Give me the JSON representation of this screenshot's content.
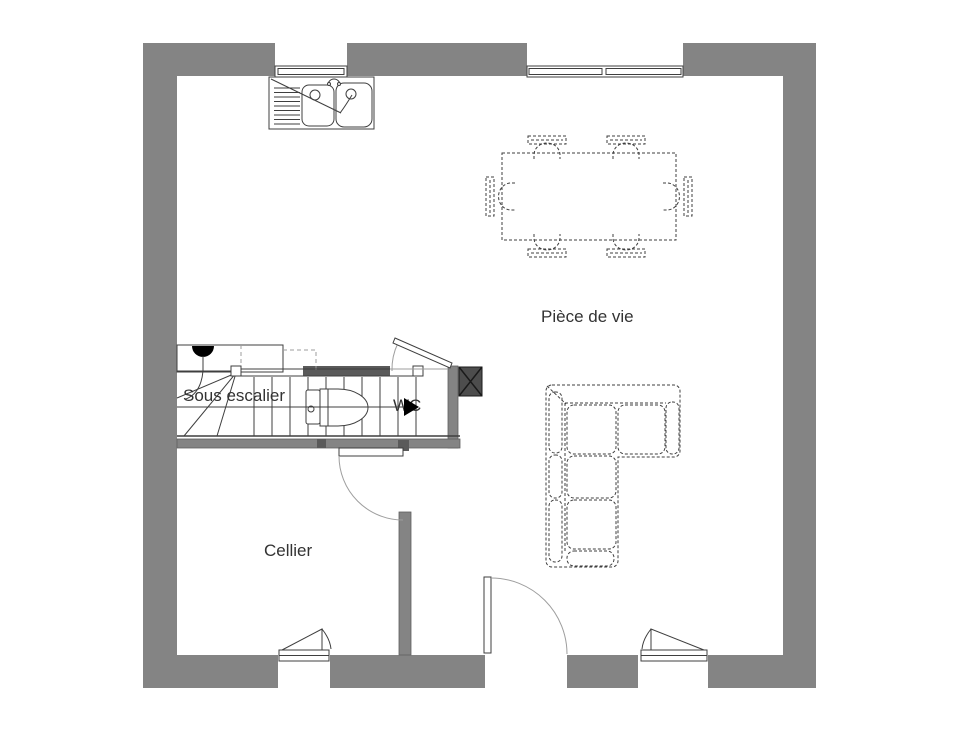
{
  "labels": {
    "living_room": "Pièce de vie",
    "cellar": "Cellier",
    "under_stairs": "Sous escalier",
    "wc": "WC"
  },
  "colors": {
    "wall": "#848484",
    "wall_dark": "#5a5a5a",
    "column": "#4d4d4d",
    "line": "#3f3f3f",
    "line_light": "#9e9e9e",
    "text": "#333333",
    "background": "#ffffff"
  },
  "furniture_icons": [
    "kitchen-double-sink-icon",
    "dining-table-icon",
    "chair-icon",
    "corner-sofa-icon",
    "toilet-icon",
    "staircase-icon"
  ]
}
